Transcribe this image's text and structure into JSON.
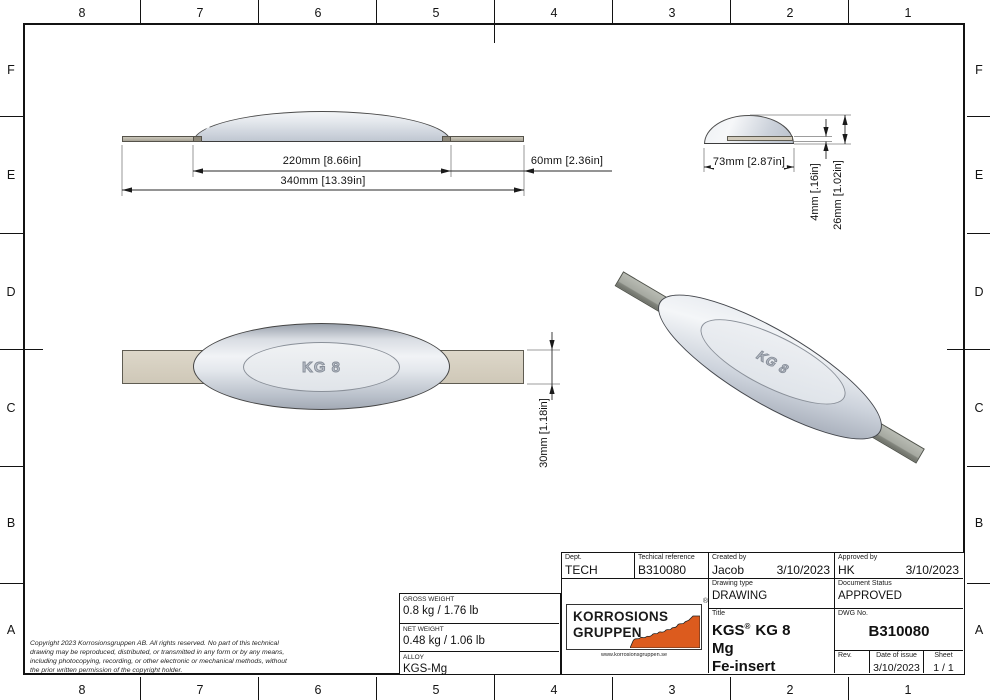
{
  "grid": {
    "cols": [
      "8",
      "7",
      "6",
      "5",
      "4",
      "3",
      "2",
      "1"
    ],
    "rows": [
      "F",
      "E",
      "D",
      "C",
      "B",
      "A"
    ]
  },
  "views": {
    "part_marking": "KG 8",
    "dims": {
      "body_length": "220mm [8.66in]",
      "overall_length": "340mm [13.39in]",
      "strap_extension": "60mm [2.36in]",
      "body_width": "73mm [2.87in]",
      "strap_thickness": "4mm [.16in]",
      "body_height": "26mm [1.02in]",
      "strap_width": "30mm [1.18in]"
    }
  },
  "title_block": {
    "dept_label": "Dept.",
    "dept": "TECH",
    "techref_label": "Techical reference",
    "techref": "B310080",
    "created_label": "Created by",
    "created_name": "Jacob",
    "created_date": "3/10/2023",
    "approved_label": "Approved by",
    "approved_name": "HK",
    "approved_date": "3/10/2023",
    "drawing_type_label": "Drawing type",
    "drawing_type": "DRAWING",
    "status_label": "Document Status",
    "status": "APPROVED",
    "title_label": "Title",
    "title_prefix": "KGS",
    "title_reg": "®",
    "title_suffix": "KG 8",
    "title_line2": "Mg",
    "title_line3": "Fe-insert",
    "dwg_label": "DWG No.",
    "dwg_no": "B310080",
    "rev_label": "Rev.",
    "rev": "",
    "issue_label": "Date of issue",
    "issue_date": "3/10/2023",
    "sheet_label": "Sheet",
    "sheet": "1 / 1"
  },
  "weights": {
    "gross_label": "GROSS WEIGHT",
    "gross": "0.8 kg / 1.76 lb",
    "net_label": "NET WEIGHT",
    "net": "0.48 kg / 1.06 lb",
    "alloy_label": "ALLOY",
    "alloy": "KGS-Mg"
  },
  "logo": {
    "line1": "KORROSIONS",
    "line2": "GRUPPEN",
    "reg": "®",
    "url": "www.korrosionsgruppen.se",
    "orange": "#DC5B1E"
  },
  "copyright": {
    "line1": "Copyright 2023 Korrosionsgruppen AB. All rights reserved. No part of this technical",
    "line2": "drawing may be reproduced, distributed, or transmitted in any form or by any means,",
    "line3": "including photocopying, recording, or other electronic or mechanical methods, without",
    "line4": "the prior written permission of the copyright holder."
  }
}
